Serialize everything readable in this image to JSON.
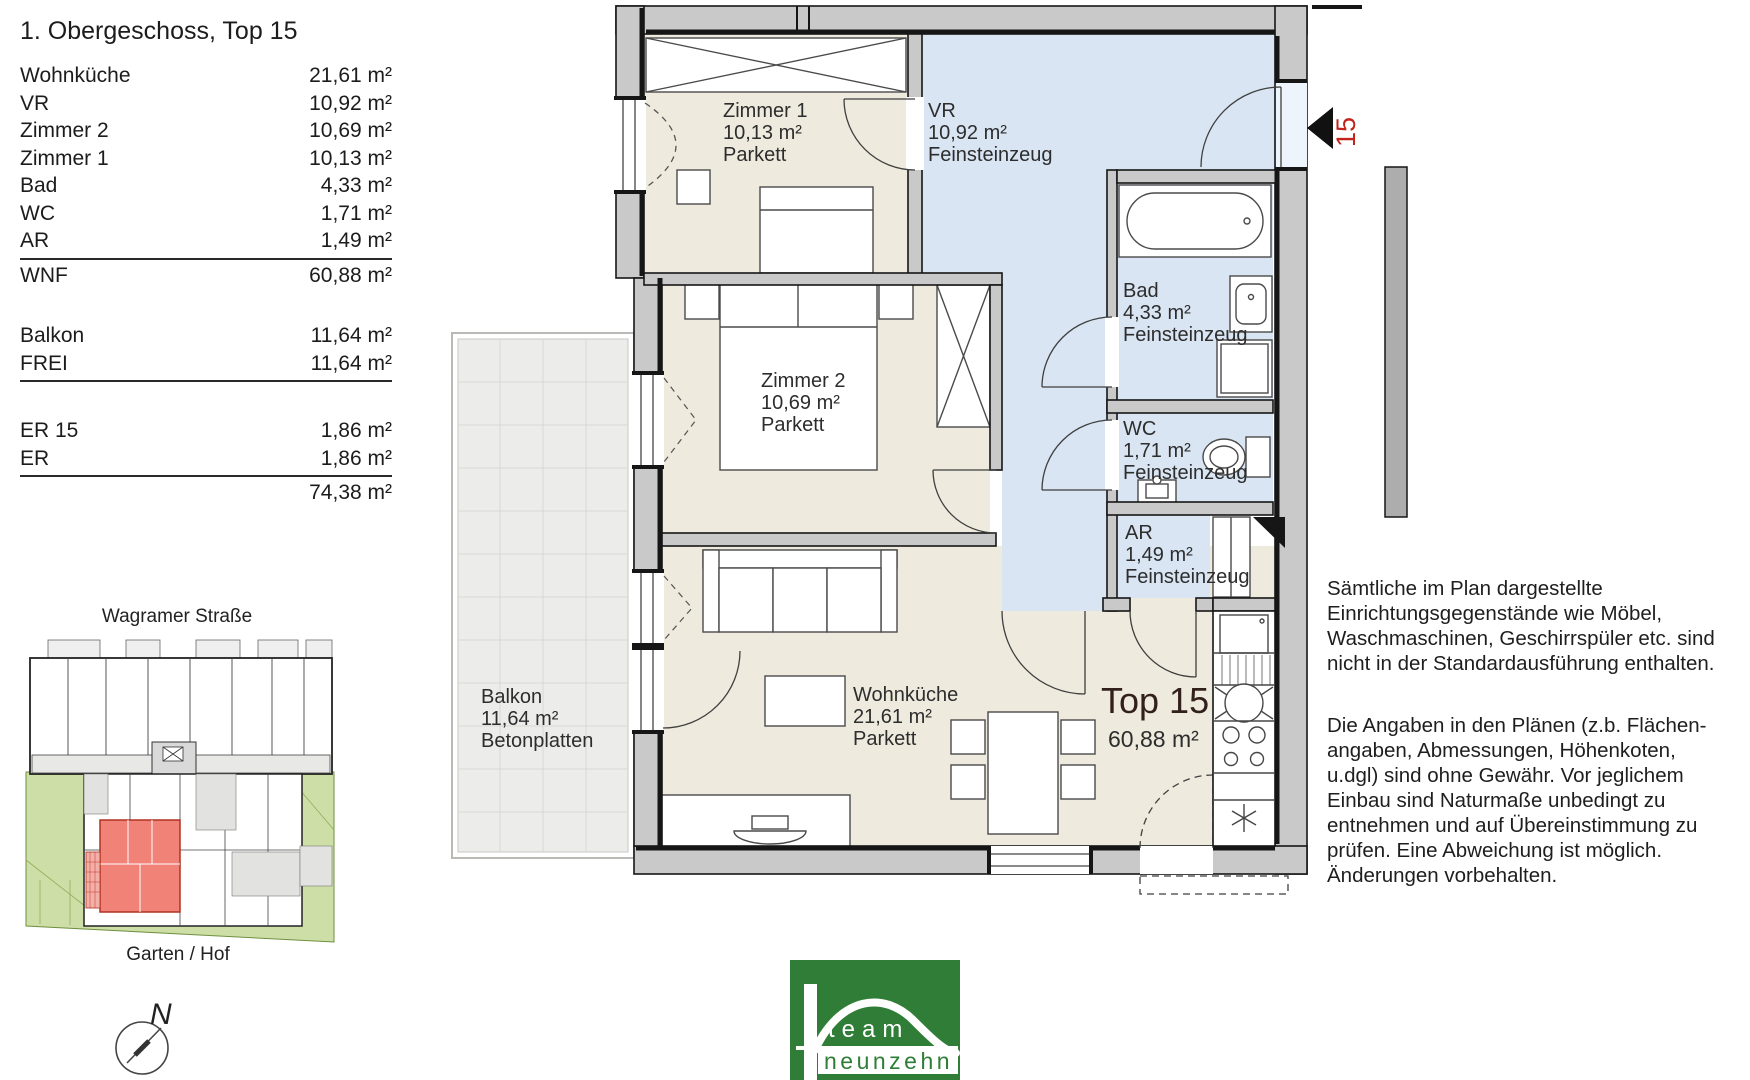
{
  "meta": {
    "title": "1. Obergeschoss, Top 15"
  },
  "area_table": {
    "rows": [
      {
        "label": "Wohnküche",
        "value": "21,61 m²"
      },
      {
        "label": "VR",
        "value": "10,92 m²"
      },
      {
        "label": "Zimmer 2",
        "value": "10,69 m²"
      },
      {
        "label": "Zimmer 1",
        "value": "10,13 m²"
      },
      {
        "label": "Bad",
        "value": "4,33 m²"
      },
      {
        "label": "WC",
        "value": "1,71 m²"
      },
      {
        "label": "AR",
        "value": "1,49 m²"
      },
      {
        "label": "WNF",
        "value": "60,88 m²"
      },
      {
        "label": "Balkon",
        "value": "11,64 m²"
      },
      {
        "label": "FREI",
        "value": "11,64 m²"
      },
      {
        "label": "ER 15",
        "value": "1,86 m²"
      },
      {
        "label": "ER",
        "value": "1,86 m²"
      },
      {
        "label": "",
        "value": "74,38 m²"
      }
    ]
  },
  "floor_plan": {
    "rooms": {
      "zimmer1": "Zimmer 1\n10,13 m²\nParkett",
      "vr": "VR\n10,92 m²\nFeinsteinzeug",
      "zimmer2": "Zimmer 2\n10,69 m²\nParkett",
      "bad": "Bad\n4,33 m²\nFeinsteinzeug",
      "wc": "WC\n1,71 m²\nFeinsteinzeug",
      "ar": "AR\n1,49 m²\nFeinsteinzeug",
      "wohnkueche": "Wohnküche\n21,61 m²\nParkett",
      "balkon": "Balkon\n11,64 m²\nBetonplatten"
    },
    "unit_label": "Top 15",
    "unit_area": "60,88 m²",
    "entrance_number": "15",
    "colors": {
      "floor_beige": "#eeeade",
      "floor_blue": "#d9e5f3",
      "wall_gray": "#c9c9c9",
      "entrance_red": "#c2231c"
    }
  },
  "site_plan": {
    "street_label": "Wagramer Straße",
    "garden_label": "Garten / Hof",
    "compass_north": "N",
    "highlight_color": "#f08277",
    "garden_green": "#cddfa6"
  },
  "disclaimer": {
    "paragraph1": "Sämtliche im Plan dargestellte\nEinrichtungsgegenstände wie Möbel,\nWaschmaschinen, Geschirrspüler etc. sind\nnicht in der Standardausführung enthalten.",
    "paragraph2": "Die Angaben in den Plänen (z.b. Flächen-\nangaben, Abmessungen, Höhenkoten,\nu.dgl) sind ohne Gewähr. Vor jeglichem\nEinbau sind Naturmaße unbedingt zu\nentnehmen und auf Übereinstimmung zu\nprüfen. Eine Abweichung ist möglich.\nÄnderungen vorbehalten."
  },
  "logo": {
    "line1": "team",
    "line2": "neunzehn",
    "green": "#2f7d36"
  }
}
